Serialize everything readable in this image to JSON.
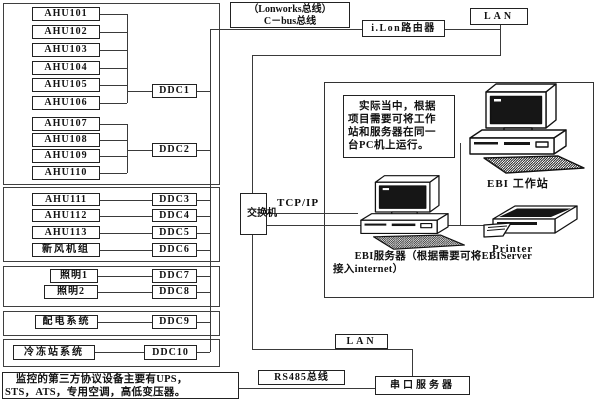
{
  "nodes": {
    "ahu": [
      "AHU101",
      "AHU102",
      "AHU103",
      "AHU104",
      "AHU105",
      "AHU106",
      "AHU107",
      "AHU108",
      "AHU109",
      "AHU110",
      "AHU111",
      "AHU112",
      "AHU113"
    ],
    "fresh_air_unit": "新风机组",
    "lighting1": "照明1",
    "lighting2": "照明2",
    "power_dist": "配电系统",
    "chiller_station": "冷冻站系统",
    "ddc": [
      "DDC1",
      "DDC2",
      "DDC3",
      "DDC4",
      "DDC5",
      "DDC6",
      "DDC7",
      "DDC8",
      "DDC9",
      "DDC10"
    ]
  },
  "network": {
    "lonworks_label": "（Lonworks总线）\nC－bus总线",
    "ilon_router": "i.Lon路由器",
    "lan_top": "LAN",
    "tcpip_label": "TCP/IP",
    "switch": "交换机",
    "lan_bottom": "LAN",
    "rs485_bus": "RS485总线",
    "serial_server": "串口服务器"
  },
  "right_panel": {
    "note": "　实际当中，根据\n项目需要可将工作\n站和服务器在同一\n台PC机上运行。",
    "workstation_label": "EBI 工作站",
    "printer_label": "Printer",
    "server_label": "　　EBI服务器（根据需要可将EBIServer\n接入internet）"
  },
  "third_party_note": "　监控的第三方协议设备主要有UPS，\nSTS，ATS，专用空调，高低变压器。"
}
